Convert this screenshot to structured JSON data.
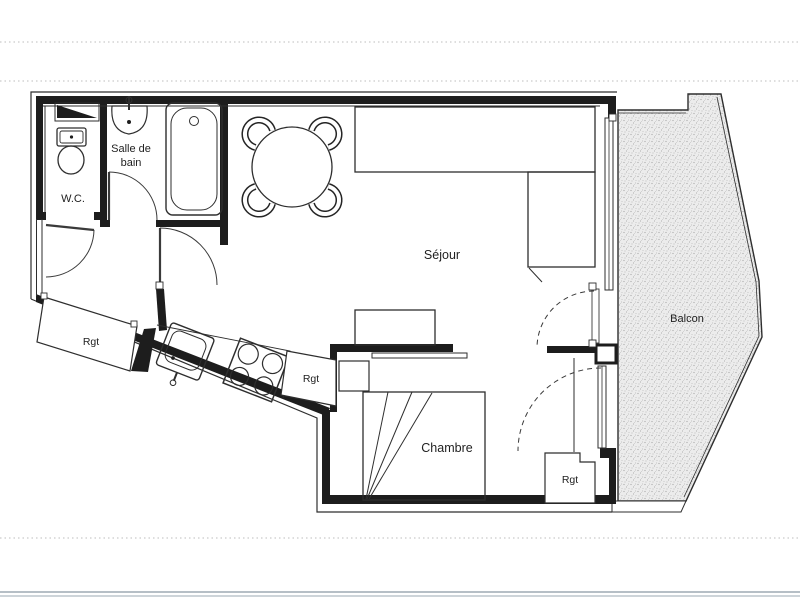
{
  "document": {
    "kind": "apartment floor plan (scanned)"
  },
  "labels": {
    "wc": "W.C.",
    "bathroom_1": "Salle de",
    "bathroom_2": "bain",
    "living_room": "Séjour",
    "balcony": "Balcon",
    "bedroom": "Chambre",
    "storage_hall": "Rgt",
    "storage_kitchen": "Rgt",
    "storage_bedroom": "Rgt"
  },
  "colors": {
    "ink": "#1d1d1d",
    "thin_line": "#2e2e2e",
    "paper": "#ffffff",
    "balcony_fill": "#ececec",
    "balcony_dot": "#a6a6a6",
    "scan_guide_line": "#c9c9c9",
    "page_rule_dark": "#b6bfc6",
    "page_rule_light": "#cdd4d9"
  }
}
